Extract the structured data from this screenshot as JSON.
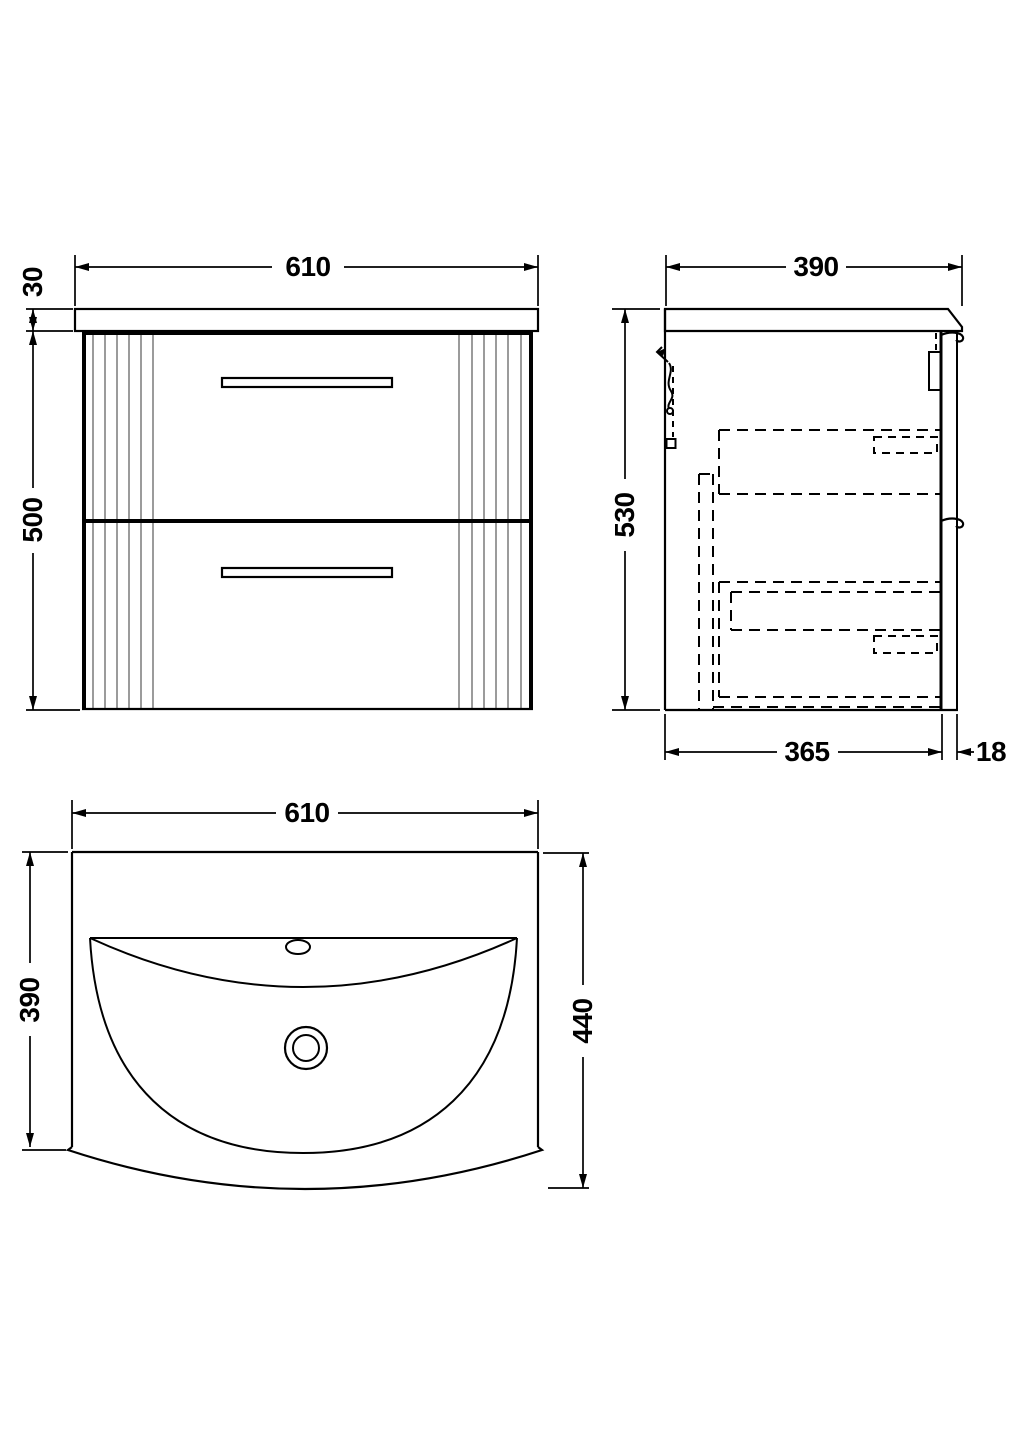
{
  "drawing": {
    "subject_labels": [],
    "colors": {
      "line": "#000000",
      "flute": "#9b9b9b",
      "background": "#ffffff"
    },
    "views": {
      "front": {
        "width": "610",
        "worktop_thickness": "30",
        "cabinet_height": "500"
      },
      "side": {
        "depth": "390",
        "overall_height": "530",
        "carcass_depth": "365",
        "front_thickness": "18"
      },
      "plan": {
        "width": "610",
        "basin_depth": "390",
        "overall_depth": "440"
      }
    }
  }
}
